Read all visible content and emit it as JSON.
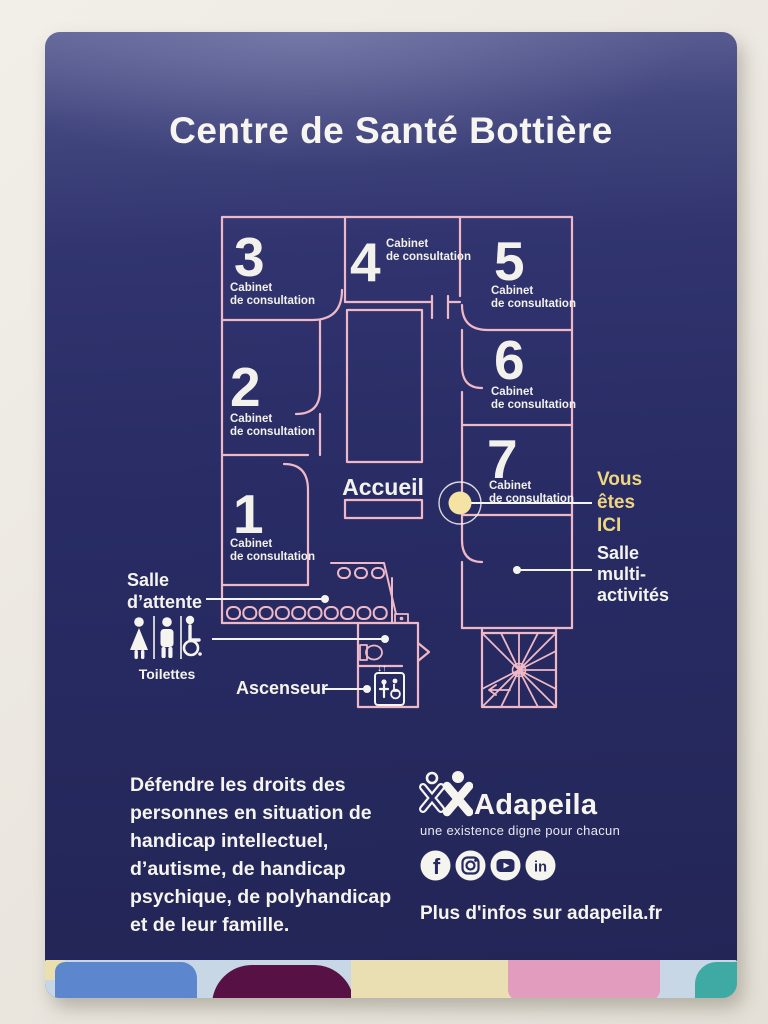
{
  "sign": {
    "title": "Centre de Santé Bottière",
    "floorplan": {
      "rooms": [
        {
          "number": "1",
          "label": [
            "Cabinet",
            "de consultation"
          ]
        },
        {
          "number": "2",
          "label": [
            "Cabinet",
            "de consultation"
          ]
        },
        {
          "number": "3",
          "label": [
            "Cabinet",
            "de consultation"
          ]
        },
        {
          "number": "4",
          "label": [
            "Cabinet",
            "de consultation"
          ]
        },
        {
          "number": "5",
          "label": [
            "Cabinet",
            "de consultation"
          ]
        },
        {
          "number": "6",
          "label": [
            "Cabinet",
            "de consultation"
          ]
        },
        {
          "number": "7",
          "label": [
            "Cabinet",
            "de consultation"
          ]
        }
      ],
      "reception_label": "Accueil",
      "you_are_here": [
        "Vous",
        "êtes",
        "ICI"
      ],
      "multi_activity_room": [
        "Salle",
        "multi-",
        "activités"
      ],
      "waiting_room": [
        "Salle",
        "d’attente"
      ],
      "toilets_label": "Toilettes",
      "elevator_label": "Ascenseur",
      "elevator_arrows": "↓↑"
    },
    "footer": {
      "mission": [
        "Défendre les droits des",
        "personnes en situation de",
        "handicap intellectuel,",
        "d’autisme, de handicap",
        "psychique, de polyhandicap",
        "et de leur famille."
      ],
      "brand_name": "Adapeila",
      "brand_tagline": "une existence digne pour chacun",
      "social": {
        "facebook_glyph": "f",
        "linkedin_glyph": "in"
      },
      "more_info": "Plus d'infos sur adapeila.fr"
    },
    "colors": {
      "panel_navy": "#2a2d66",
      "plan_pink": "#efb8c7",
      "marker_yellow": "#f4e3a2",
      "text_white": "#f6f4ef"
    }
  }
}
